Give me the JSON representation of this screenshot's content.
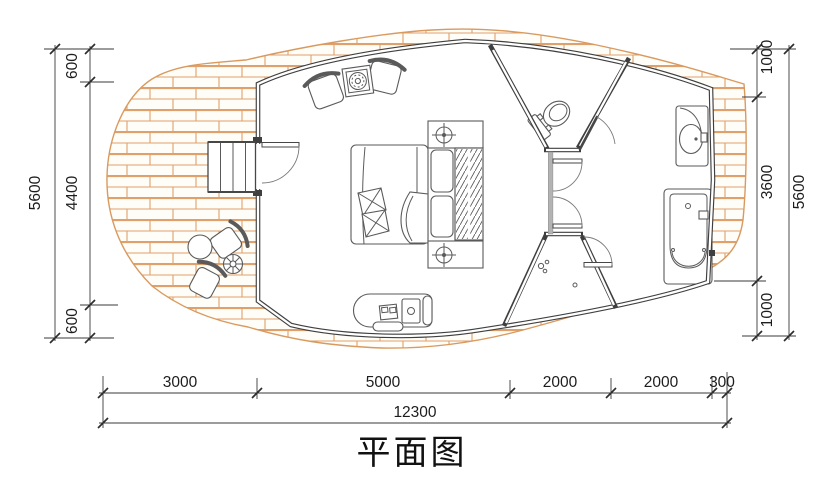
{
  "title": "平面图",
  "dimensions": {
    "left": {
      "overall": "5600",
      "parts": [
        "600",
        "4400",
        "600"
      ]
    },
    "right": {
      "overall": "5600",
      "parts": [
        "1000",
        "3600",
        "1000"
      ]
    },
    "bottom": {
      "overall": "12300",
      "parts": [
        "3000",
        "5000",
        "2000",
        "2000",
        "300"
      ]
    }
  },
  "colors": {
    "deck_hatch": "#dfa06b",
    "wall": "#3f3f3f",
    "furniture_line": "#5a5a5a",
    "dimension_line": "#3a3a3a",
    "paper": "#ffffff"
  }
}
